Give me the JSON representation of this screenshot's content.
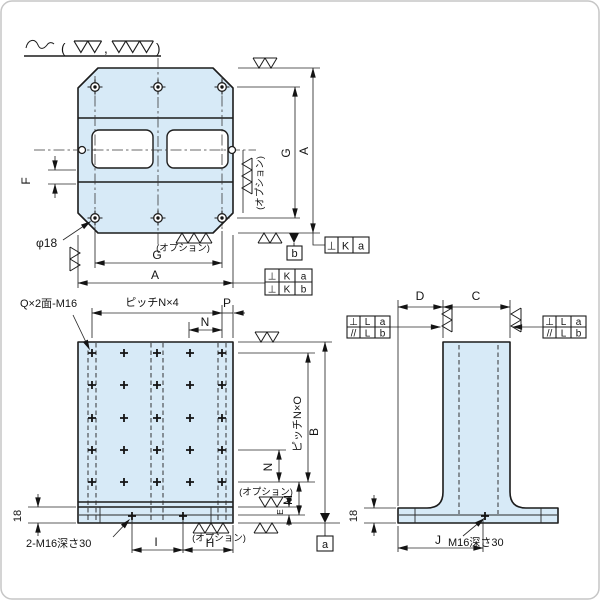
{
  "colors": {
    "part_fill": "#d7eaf7",
    "line": "#1c1c1c"
  },
  "finish_note": {
    "open": "(",
    "comma": ",",
    "close": ")"
  },
  "top_view": {
    "dim_F": "F",
    "hole_label": "φ18",
    "dim_G_bottom": "G",
    "dim_A_bottom": "A",
    "dim_G_right": "G",
    "dim_A_right": "A",
    "option_right": "(オプション)",
    "option_bottom": "(オプション)",
    "datum_b": "b",
    "fcf_top": {
      "sym": "⊥",
      "tol": "K",
      "datum": "a"
    },
    "fcf_bottom": {
      "row1": {
        "sym": "⊥",
        "tol": "K",
        "datum": "a"
      },
      "row2": {
        "sym": "⊥",
        "tol": "K",
        "datum": "b"
      }
    }
  },
  "front_view": {
    "tap_label": "Q×2面-M16",
    "dim_pitch_top": "ピッチN×4",
    "dim_N_top": "N",
    "dim_P": "P",
    "dim_B": "B",
    "dim_pitch_right": "ピッチN×O",
    "dim_N_right": "N",
    "dim_M": "M",
    "dim_E": "E",
    "option_right": "(オプション)",
    "option_bottom": "(オプション)",
    "dim_18": "18",
    "base_tap_label": "2-M16深さ30",
    "dim_I": "I",
    "dim_H": "H",
    "datum_a": "a"
  },
  "side_view": {
    "dim_D": "D",
    "dim_C": "C",
    "dim_J": "J",
    "dim_18": "18",
    "base_tap_label": "M16深さ30",
    "fcf_left": {
      "row1": {
        "sym": "⊥",
        "tol": "L",
        "datum": "a"
      },
      "row2": {
        "sym": "//",
        "tol": "L",
        "datum": "b"
      }
    },
    "fcf_right": {
      "row1": {
        "sym": "⊥",
        "tol": "L",
        "datum": "a"
      },
      "row2": {
        "sym": "//",
        "tol": "L",
        "datum": "b"
      }
    }
  }
}
